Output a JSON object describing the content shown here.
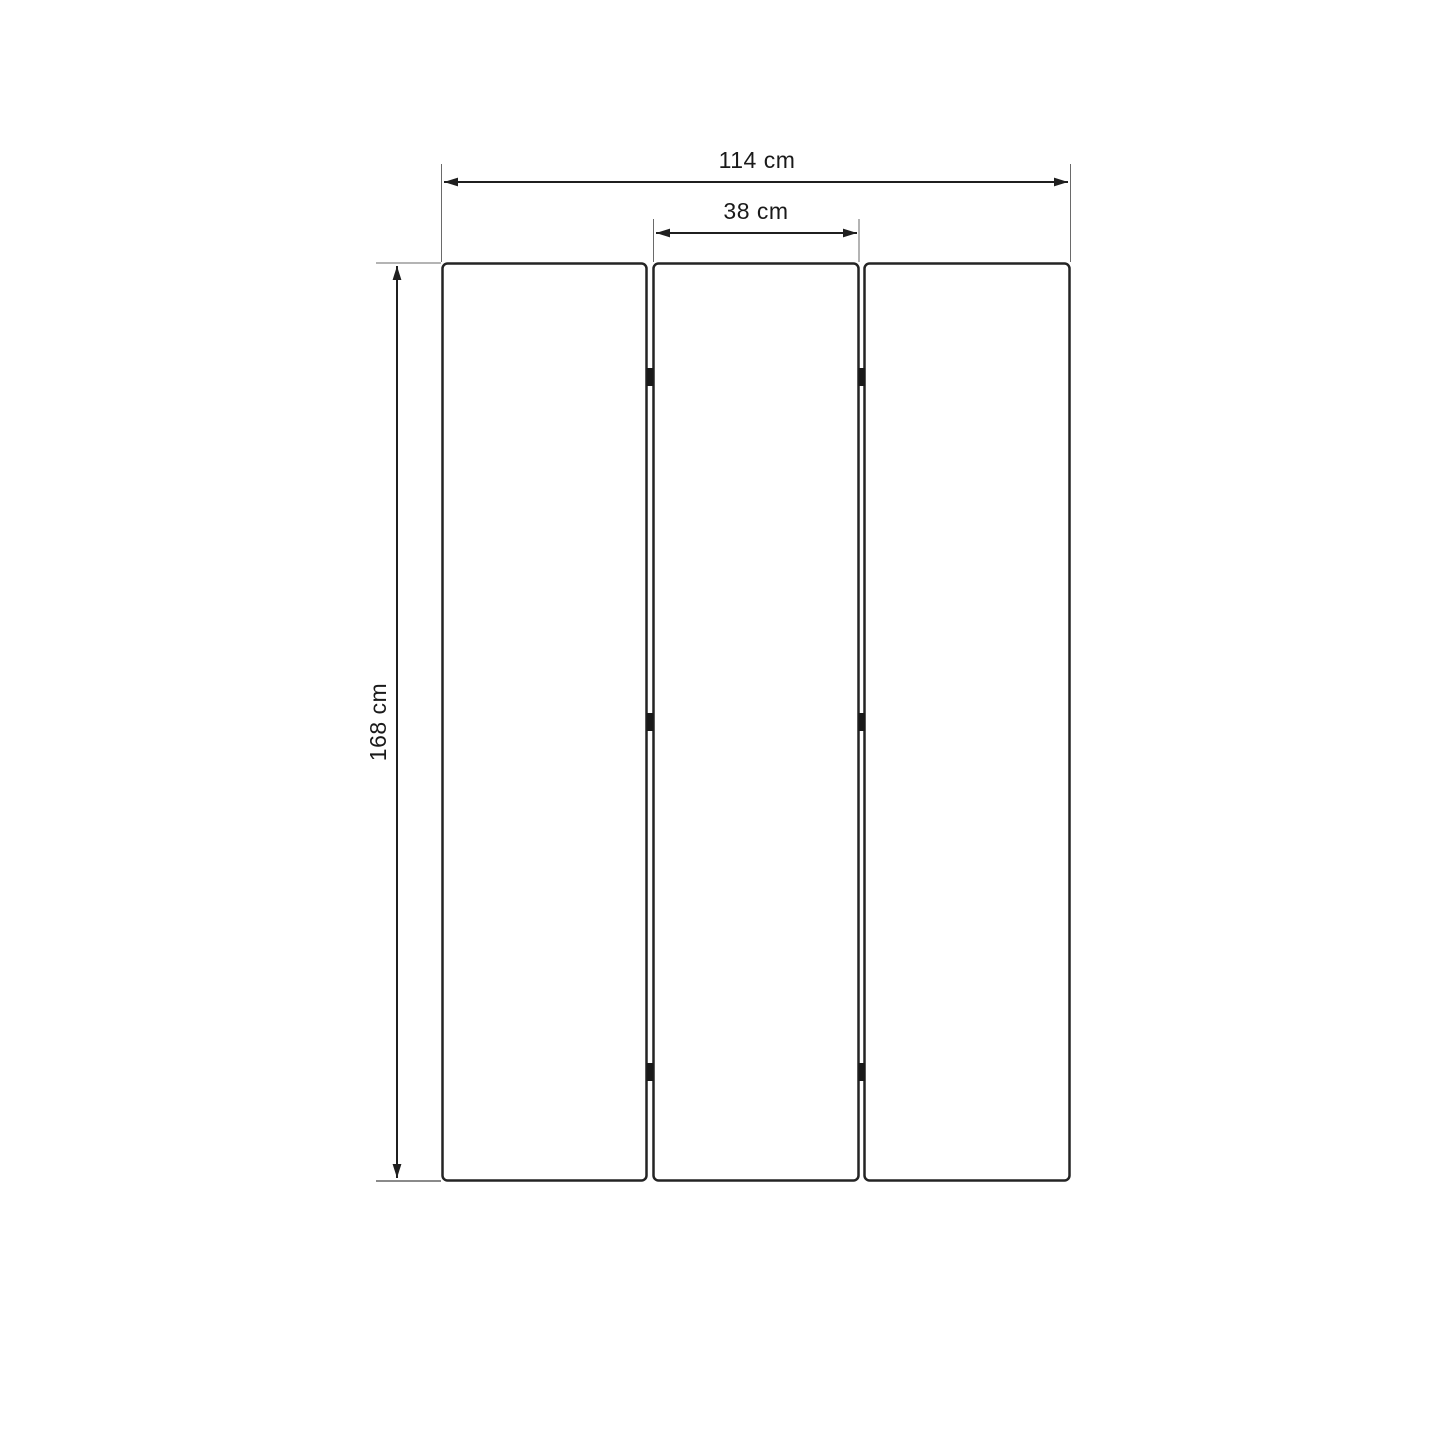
{
  "diagram": {
    "type": "product-dimension-diagram",
    "subject": "three-panel folding screen (front view)",
    "panels": {
      "count": 3,
      "hinges_per_gap": 3
    },
    "dimensions": {
      "total_width": {
        "label": "114 cm",
        "value": 114,
        "unit": "cm",
        "orientation": "horizontal"
      },
      "panel_width": {
        "label": "38 cm",
        "value": 38,
        "unit": "cm",
        "orientation": "horizontal"
      },
      "height": {
        "label": "168 cm",
        "value": 168,
        "unit": "cm",
        "orientation": "vertical"
      }
    },
    "colors": {
      "background": "#ffffff",
      "outline": "#242424",
      "dimension_line": "#1f1f1f",
      "extension_line": "#6a6a6a",
      "text": "#1a1a1a"
    }
  }
}
